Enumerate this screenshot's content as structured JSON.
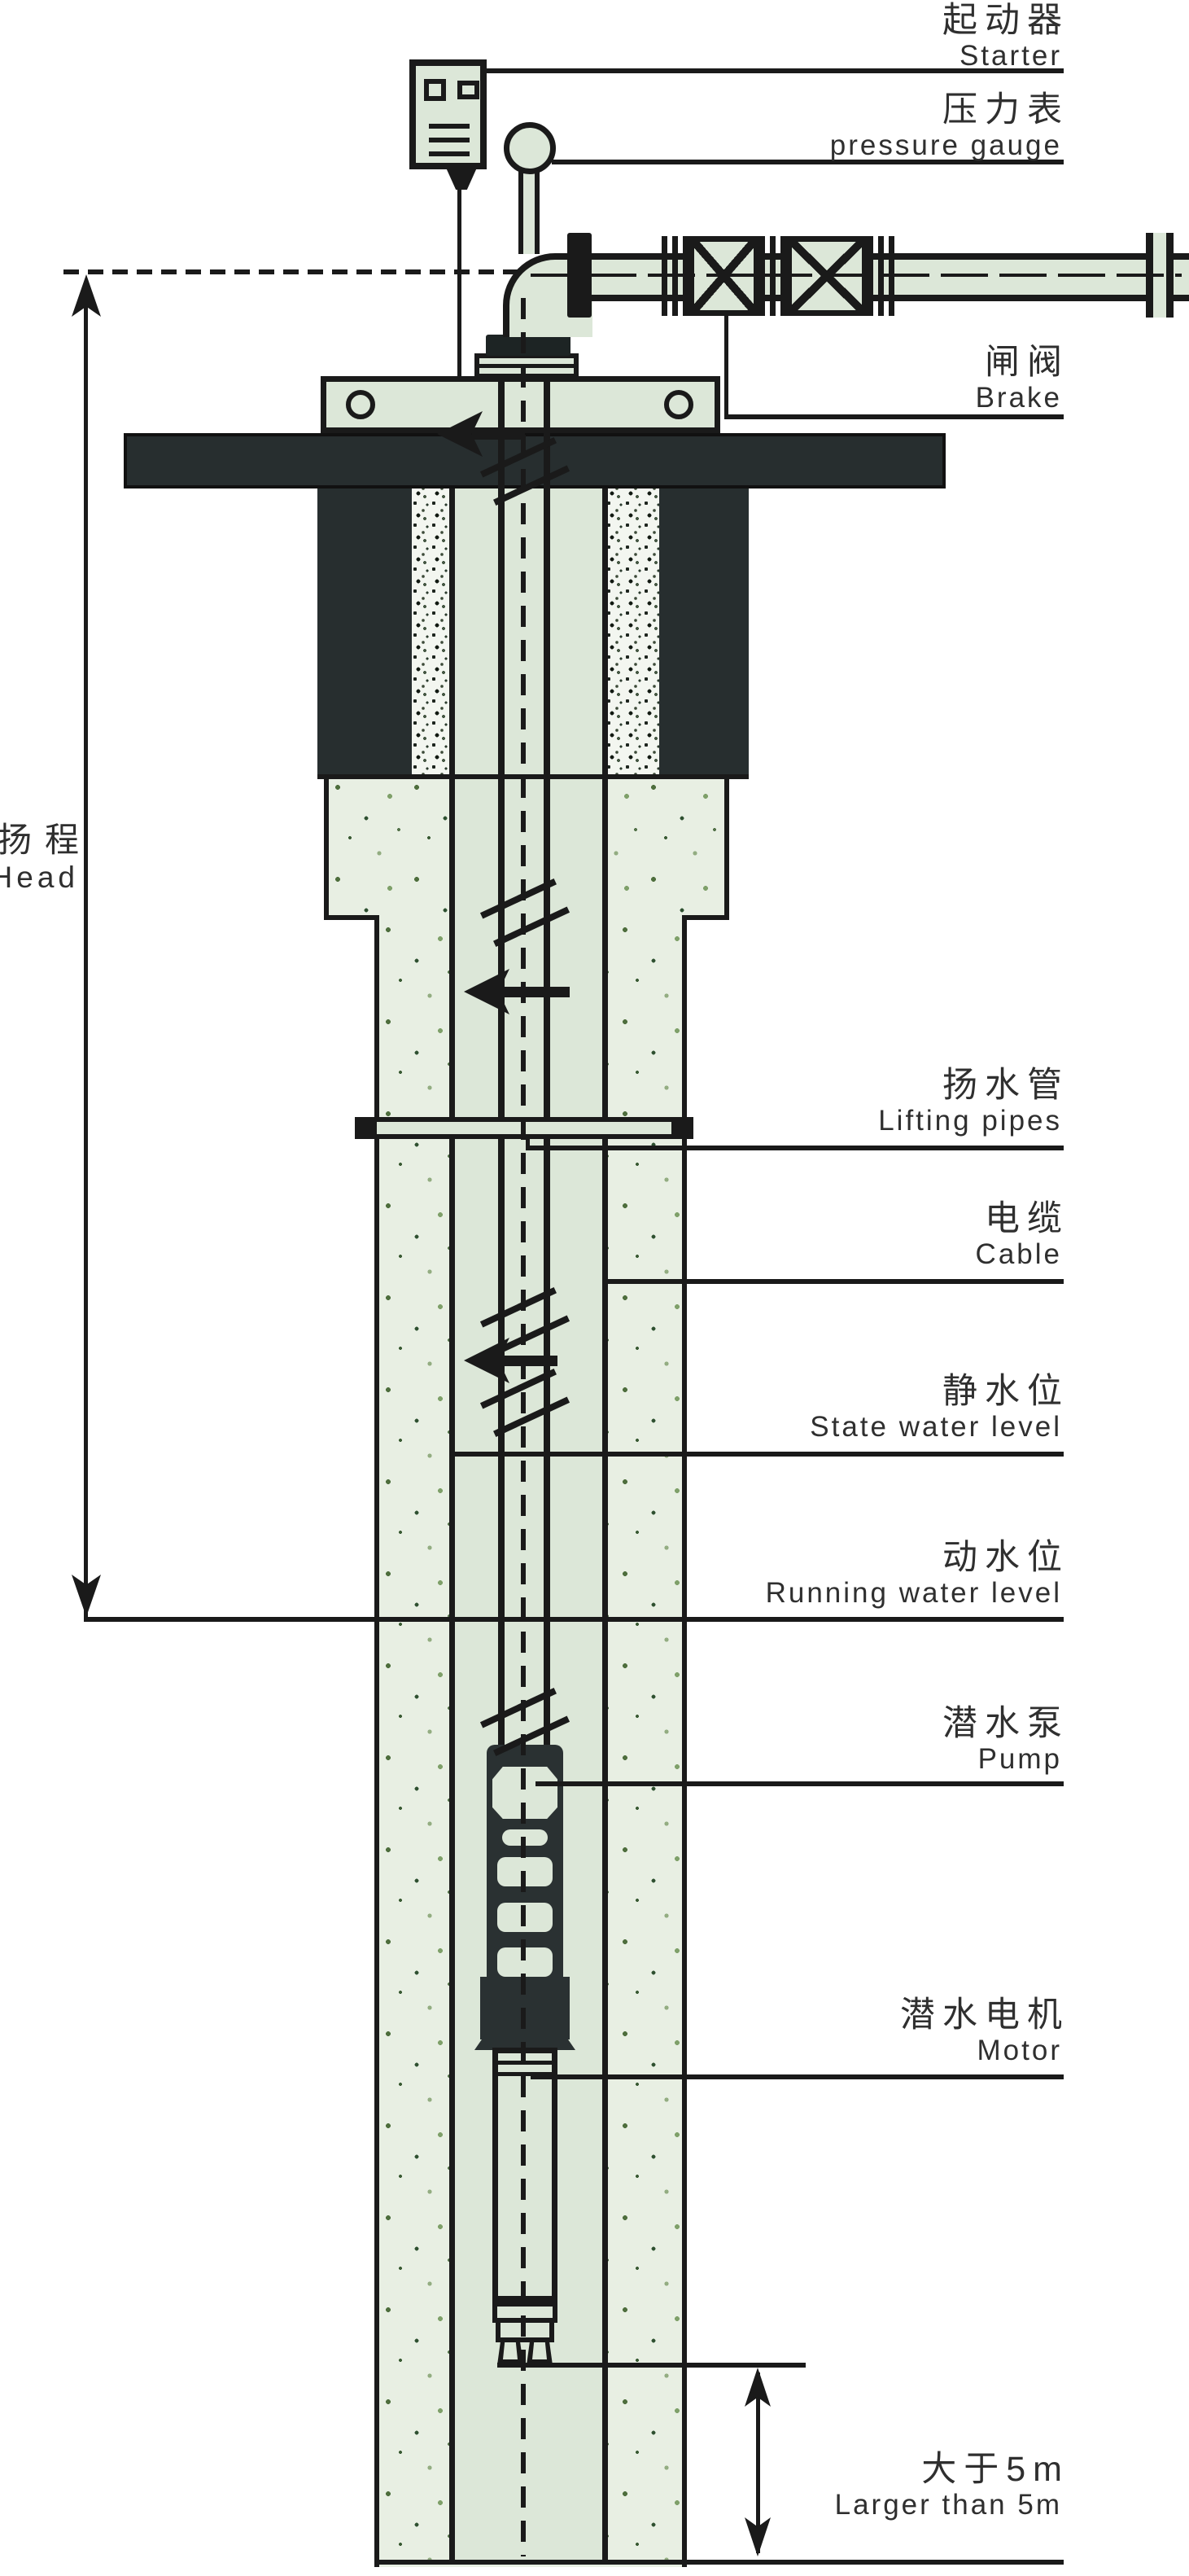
{
  "diagram": "submersible-pump-well-installation",
  "labels": {
    "starter": {
      "zh": "起动器",
      "en": "Starter"
    },
    "pressure_gauge": {
      "zh": "压力表",
      "en": "pressure gauge"
    },
    "brake": {
      "zh": "闸阀",
      "en": "Brake"
    },
    "lifting_pipes": {
      "zh": "扬水管",
      "en": "Lifting pipes"
    },
    "cable": {
      "zh": "电缆",
      "en": "Cable"
    },
    "static_water_level": {
      "zh": "静水位",
      "en": "State water level"
    },
    "running_water_level": {
      "zh": "动水位",
      "en": "Running water level"
    },
    "pump": {
      "zh": "潜水泵",
      "en": "Pump"
    },
    "motor": {
      "zh": "潜水电机",
      "en": "Motor"
    },
    "larger_than_5m": {
      "zh": "大于5m",
      "en": "Larger than 5m"
    },
    "head": {
      "zh": "扬程",
      "en": "Head"
    }
  },
  "colors": {
    "line": "#1a1a1a",
    "fitting_fill": "#dce7d8",
    "foundation_dark": "#272e2f",
    "soil_speckle_bg": "#e8efe3",
    "gravel_bg": "#f3f6f0",
    "label_text": "#2f2f2f"
  }
}
